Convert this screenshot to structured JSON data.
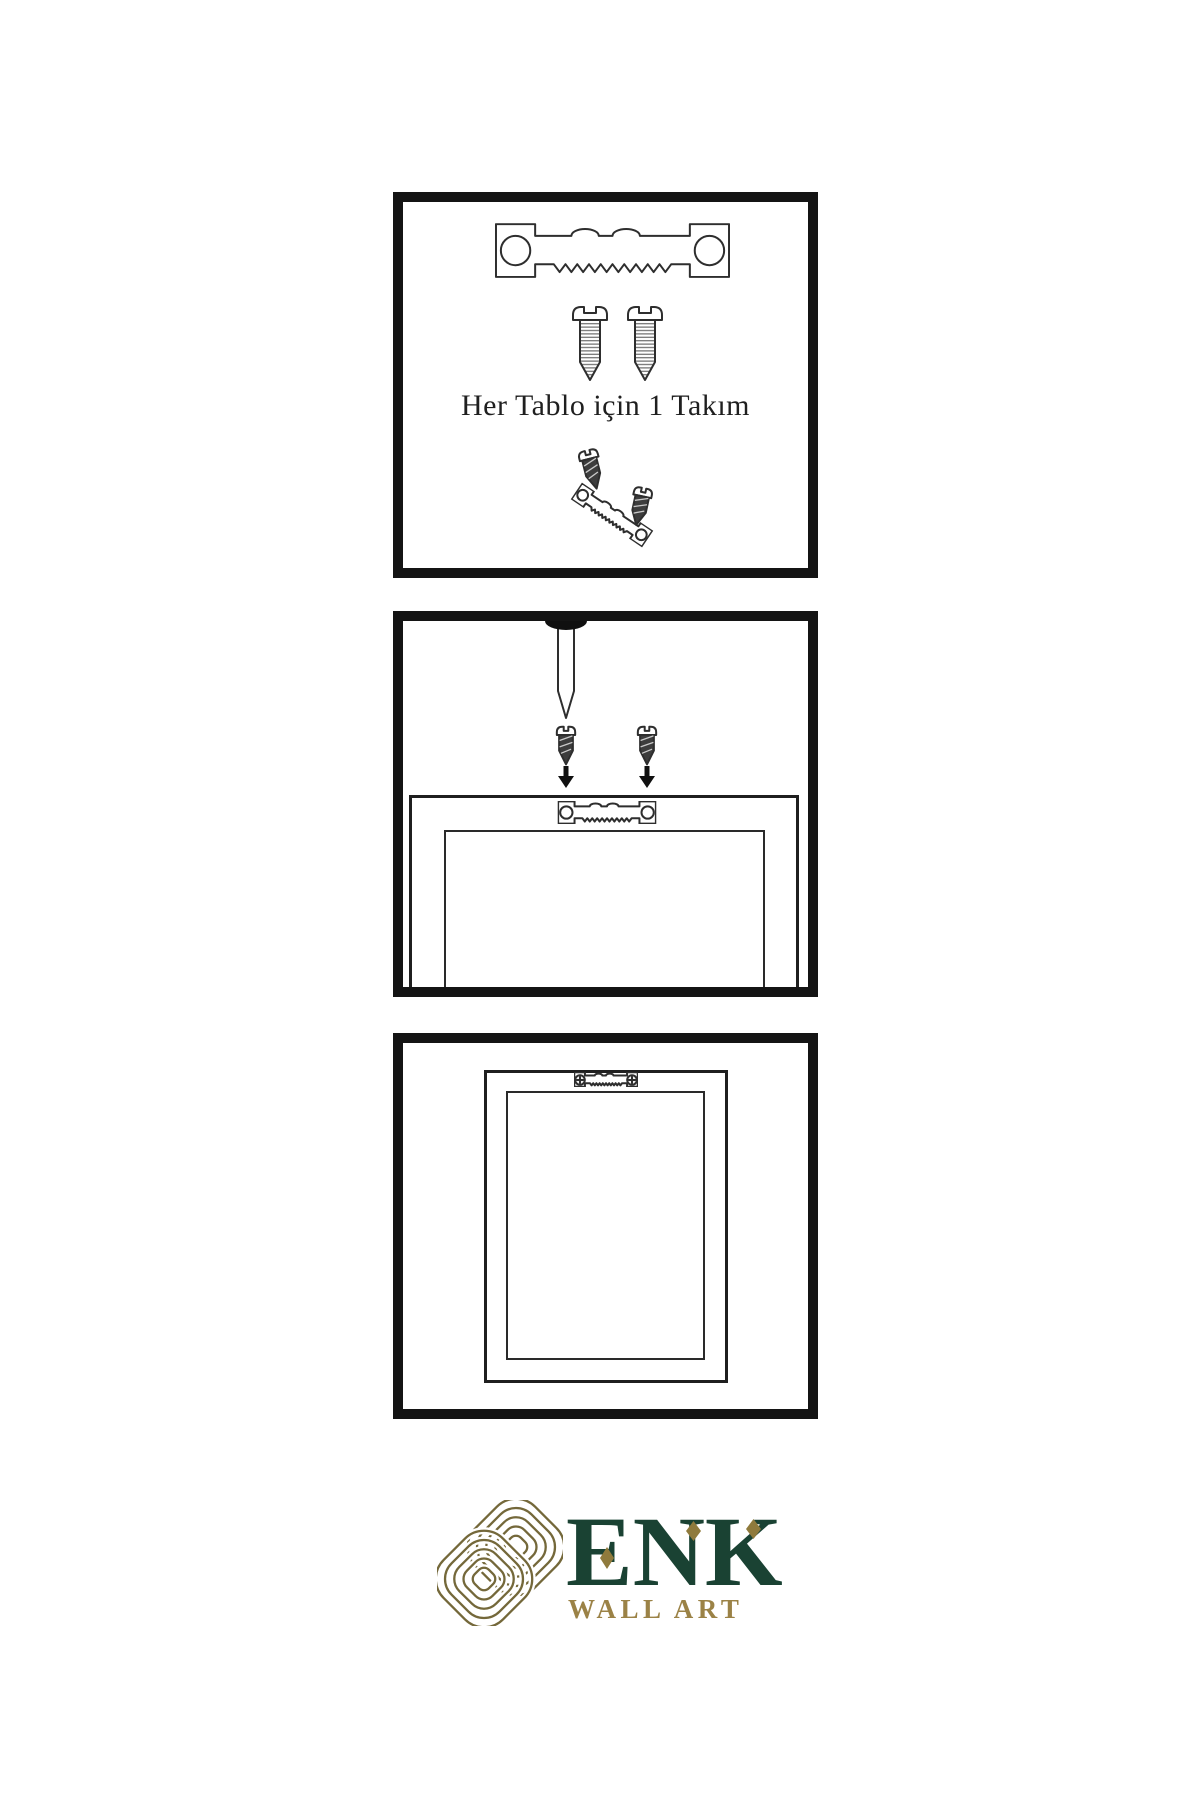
{
  "sheet": {
    "background": "#ffffff",
    "panel_border_color": "#141414",
    "line_color": "#2e2e2e"
  },
  "panels": {
    "kit": {
      "caption": "Her Tablo için 1 Takım"
    },
    "install": {
      "caption": ""
    },
    "result": {
      "caption": ""
    }
  },
  "logo": {
    "brand": "ENK",
    "subtitle": "WALL ART",
    "green": "#1a4233",
    "gold": "#9b8246",
    "knot_color": "#74683a"
  },
  "icons": {
    "sawtooth_hanger": "sawtooth picture-hanger bar with two screw holes",
    "screw": "wood screw",
    "screw_dark": "dark wood screw",
    "nail": "wall nail",
    "arrow_down": "▼",
    "phillips_screw_head": "⊕",
    "knot": "interlaced knot logo mark",
    "diamond_accent": "◆"
  }
}
